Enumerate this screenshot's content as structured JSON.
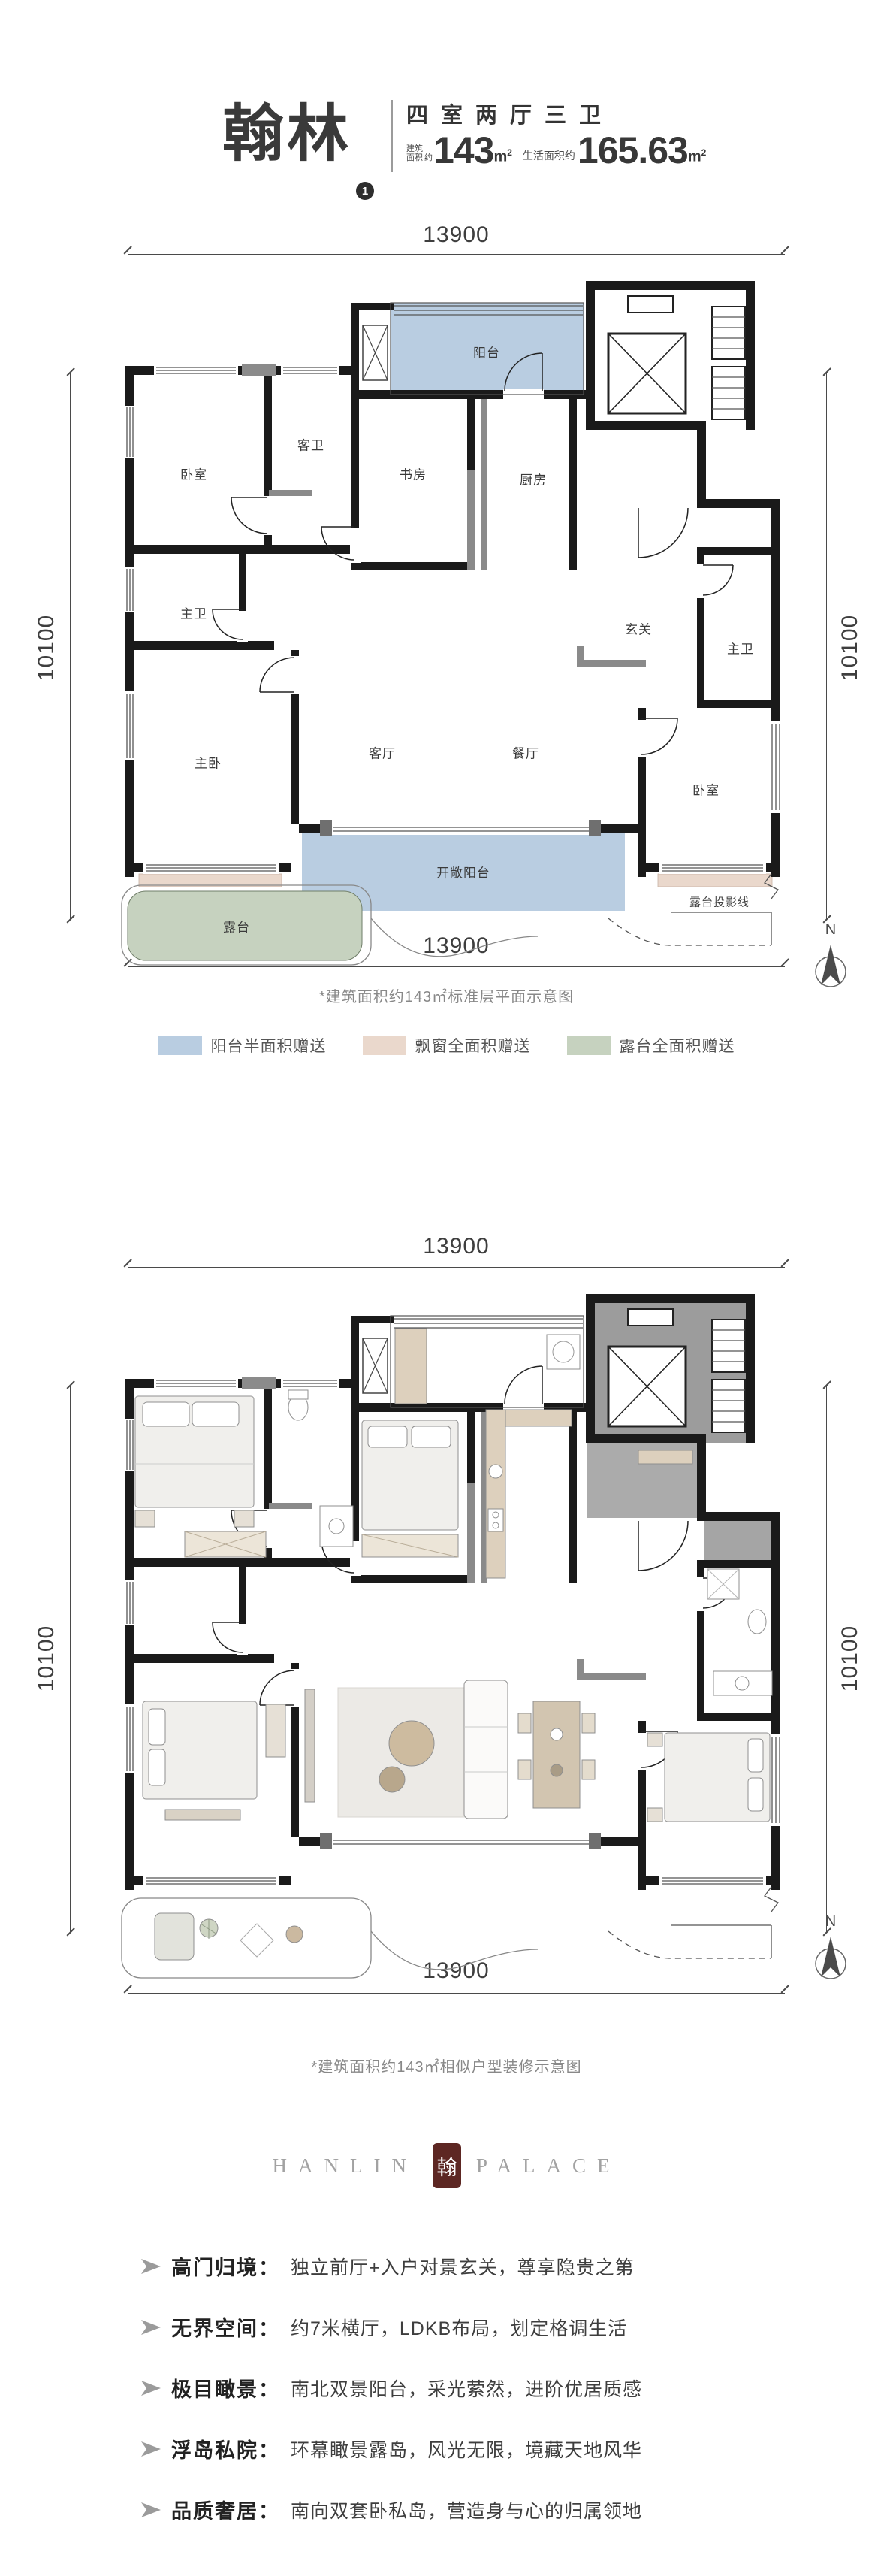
{
  "header": {
    "title": "翰林",
    "badge": "1",
    "layout": "四室两厅三卫",
    "area1_label_line1": "建筑",
    "area1_label_line2": "面积",
    "area1_approx": "约",
    "area1_value": "143",
    "area1_unit_base": "m",
    "area1_unit_sup": "2",
    "area2_label": "生活面积约",
    "area2_value": "165.63",
    "area2_unit_base": "m",
    "area2_unit_sup": "2"
  },
  "plan1": {
    "caption": "*建筑面积约143㎡标准层平面示意图",
    "compass": "N",
    "dims": {
      "top": "13900",
      "bottom": "13900",
      "left": "10100",
      "right": "10100"
    },
    "rooms": {
      "balcony": "阳台",
      "bedroom_top_left": "卧室",
      "guest_bath": "客卫",
      "study": "书房",
      "kitchen": "厨房",
      "foyer": "玄关",
      "master_bath_left": "主卫",
      "master_bath_right": "主卫",
      "master_bedroom": "主卧",
      "living_room": "客厅",
      "dining_room": "餐厅",
      "bedroom_right": "卧室",
      "open_balcony": "开敞阳台",
      "terrace": "露台",
      "terrace_projection_line": "露台投影线"
    }
  },
  "legend": {
    "items": [
      {
        "label": "阳台半面积赠送",
        "color": "#b9cde1"
      },
      {
        "label": "飘窗全面积赠送",
        "color": "#ead8cc"
      },
      {
        "label": "露台全面积赠送",
        "color": "#c6d2bf"
      }
    ]
  },
  "plan2": {
    "caption": "*建筑面积约143㎡相似户型装修示意图",
    "compass": "N",
    "dims": {
      "top": "13900",
      "bottom": "13900",
      "left": "10100",
      "right": "10100"
    }
  },
  "logo": {
    "word_left": "HANLIN",
    "word_right": "PALACE",
    "seal_char": "翰",
    "seal_color": "#5d2723"
  },
  "features": [
    {
      "title": "高门归境：",
      "text": "独立前厅+入户对景玄关，尊享隐贵之第"
    },
    {
      "title": "无界空间：",
      "text": "约7米横厅，LDKB布局，划定格调生活"
    },
    {
      "title": "极目瞰景：",
      "text": "南北双景阳台，采光萦然，进阶优居质感"
    },
    {
      "title": "浮岛私院：",
      "text": "环幕瞰景露岛，风光无限，境藏天地风华"
    },
    {
      "title": "品质奢居：",
      "text": "南向双套卧私岛，营造身与心的归属领地"
    }
  ],
  "colors": {
    "balcony_fill": "#b9cde1",
    "terrace_fill": "#c6d2bf",
    "bay_window_fill": "#ead8cc",
    "wall": "#1a1a1a"
  }
}
